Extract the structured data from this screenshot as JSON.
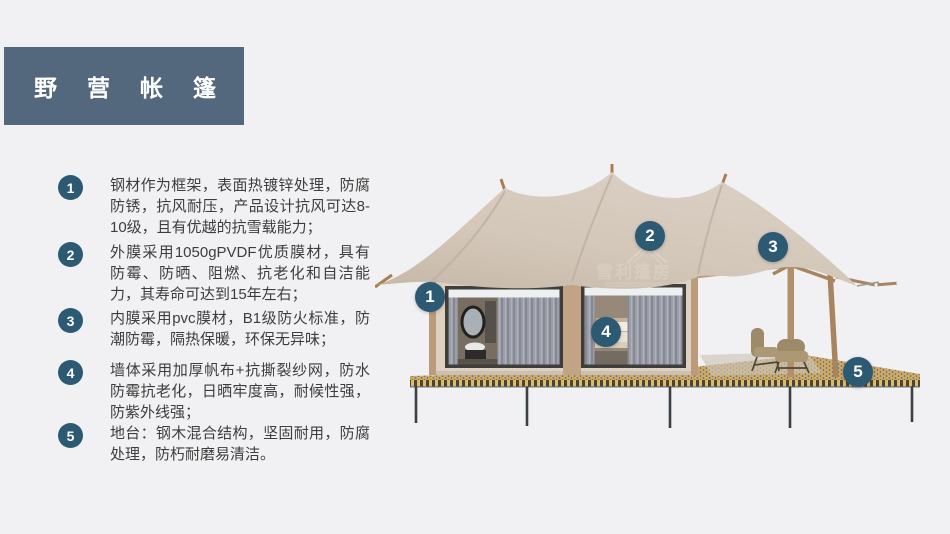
{
  "slide": {
    "background": "#f1f1f3"
  },
  "title": {
    "text": "野营帐篷"
  },
  "features": [
    {
      "num": "1",
      "text": "钢材作为框架，表面热镀锌处理，防腐防锈，抗风耐压，产品设计抗风可达8-10级，且有优越的抗雪载能力；"
    },
    {
      "num": "2",
      "text": "外膜采用1050gPVDF优质膜材，具有防霉、防晒、阻燃、抗老化和自洁能力，其寿命可达到15年左右；"
    },
    {
      "num": "3",
      "text": "内膜采用pvc膜材，B1级防火标准，防潮防霉，隔热保暖，环保无异味；"
    },
    {
      "num": "4",
      "text": "墙体采用加厚帆布+抗撕裂纱网，防水防霉抗老化，日晒牢度高，耐候性强，防紫外线强；"
    },
    {
      "num": "5",
      "text": "地台：钢木混合结构，坚固耐用，防腐处理，防朽耐磨易清洁。"
    }
  ],
  "image_markers": [
    {
      "label": "1"
    },
    {
      "label": "2"
    },
    {
      "label": "3"
    },
    {
      "label": "4"
    },
    {
      "label": "5"
    }
  ],
  "watermark": {
    "text": "雪利篷房"
  },
  "colors": {
    "title_bg": "#53687d",
    "title_text": "#ffffff",
    "badge": "#2d5a73",
    "marker": "#2d5a73",
    "body_text": "#3d3d3d",
    "roof": "#d2c6b8",
    "wall": "#ddd1c1",
    "wood": "#bb9a7a",
    "deck": "#c9aa70"
  }
}
